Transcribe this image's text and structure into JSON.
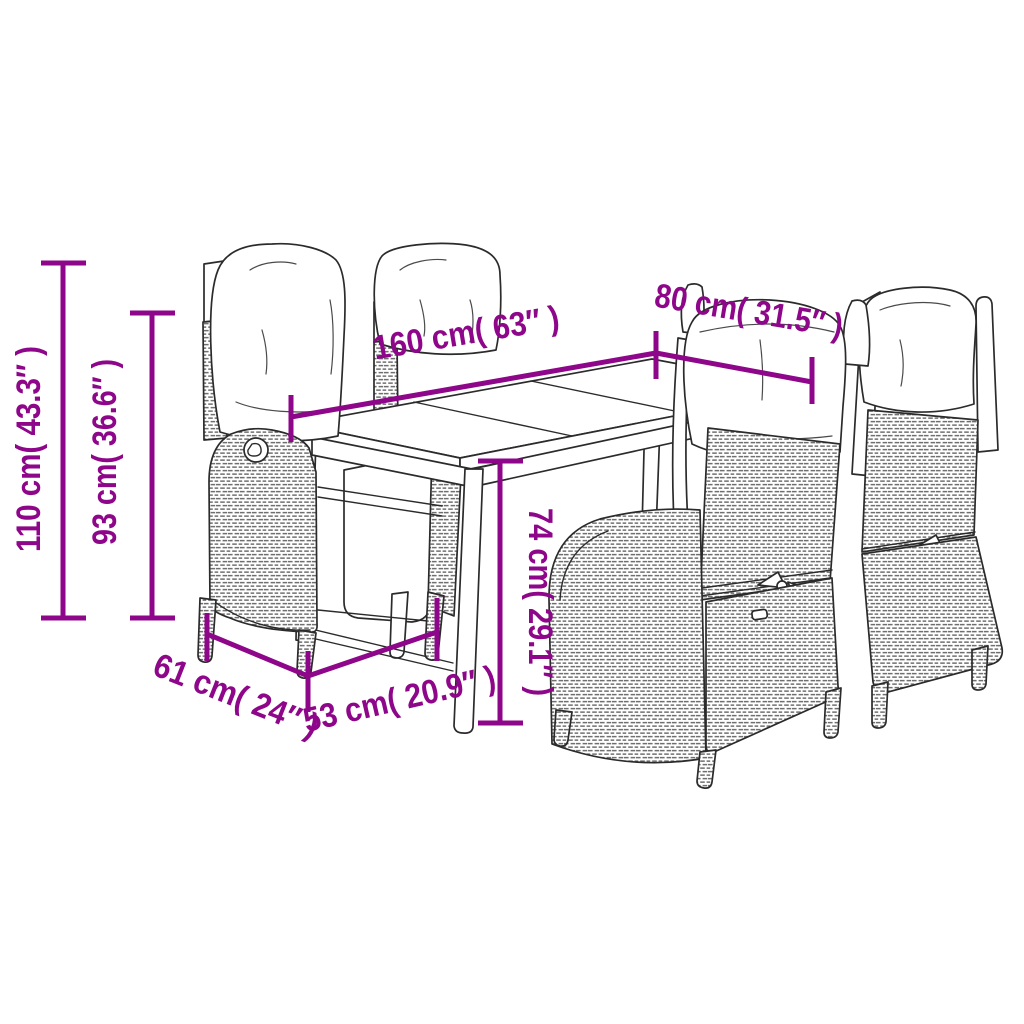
{
  "page": {
    "background": "#ffffff",
    "subject": "outdoor-dining-set-dimension-diagram",
    "pieces": [
      "dining-table",
      "reclining-chair-left-front",
      "reclining-chair-left-back",
      "reclining-chair-right-front",
      "reclining-chair-right-back"
    ]
  },
  "colors": {
    "dimension": "#8E0689",
    "line_art": "#2b2b2b",
    "background": "#ffffff"
  },
  "dimensions": {
    "total_height": {
      "label": "110 cm( 43.3″ )"
    },
    "backrest_height": {
      "label": "93 cm( 36.6″ )"
    },
    "table_length": {
      "label": "160 cm( 63″ )"
    },
    "table_width": {
      "label": "80 cm( 31.5″ )"
    },
    "table_height": {
      "label": "74 cm( 29.1″ )"
    },
    "seat_width": {
      "label": "61 cm( 24″ )"
    },
    "seat_depth": {
      "label": "53 cm( 20.9″ )"
    }
  }
}
